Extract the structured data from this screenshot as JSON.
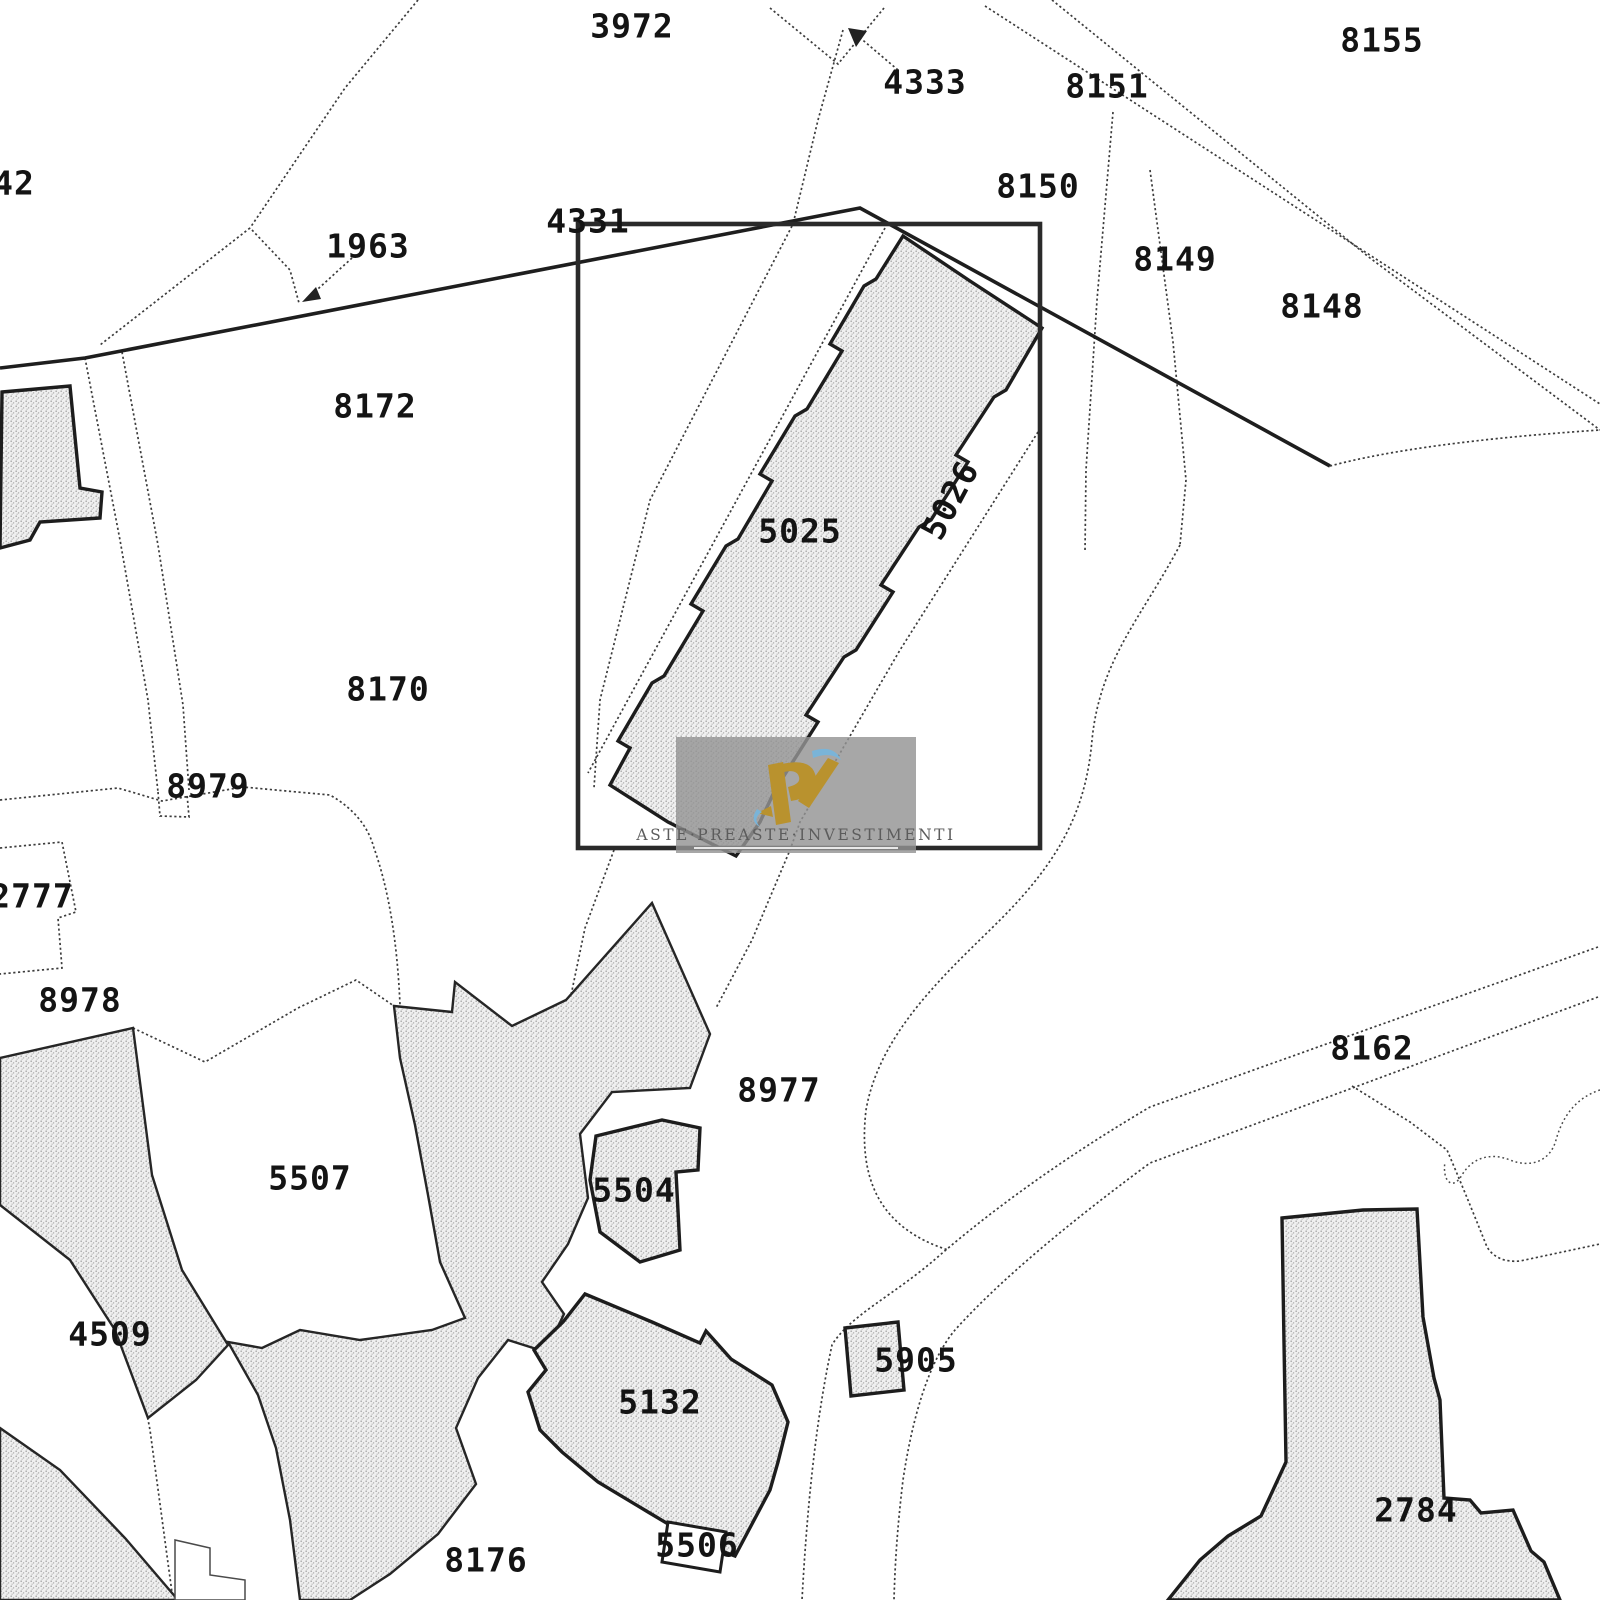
{
  "map": {
    "type": "cadastral-extract",
    "background_color": "#ffffff",
    "line_color": "#3c3c3c",
    "bold_line_color": "#1e1e1e",
    "stipple_dot_color": "#a8a8a8",
    "stipple_bg_color": "#f0f0f0",
    "label_color": "#141414",
    "highlight_box": {
      "x": 578,
      "y": 224,
      "width": 462,
      "height": 624
    },
    "labels": [
      {
        "text": "3972",
        "x": 632,
        "y": 26,
        "rotation": 0
      },
      {
        "text": "4333",
        "x": 925,
        "y": 82,
        "rotation": 0
      },
      {
        "text": "8155",
        "x": 1382,
        "y": 40,
        "rotation": 0
      },
      {
        "text": "8151",
        "x": 1107,
        "y": 86,
        "rotation": 0
      },
      {
        "text": "8150",
        "x": 1038,
        "y": 186,
        "rotation": 0
      },
      {
        "text": "8149",
        "x": 1175,
        "y": 259,
        "rotation": 0
      },
      {
        "text": "8148",
        "x": 1322,
        "y": 306,
        "rotation": 0
      },
      {
        "text": "42",
        "x": 14,
        "y": 183,
        "rotation": 0
      },
      {
        "text": "1963",
        "x": 368,
        "y": 246,
        "rotation": 0
      },
      {
        "text": "4331",
        "x": 588,
        "y": 221,
        "rotation": 0
      },
      {
        "text": "8172",
        "x": 375,
        "y": 406,
        "rotation": 0
      },
      {
        "text": "5025",
        "x": 800,
        "y": 531,
        "rotation": 0
      },
      {
        "text": "5026",
        "x": 950,
        "y": 500,
        "rotation": -62
      },
      {
        "text": "8170",
        "x": 388,
        "y": 689,
        "rotation": 0
      },
      {
        "text": "8979",
        "x": 208,
        "y": 786,
        "rotation": 0
      },
      {
        "text": "2777",
        "x": 32,
        "y": 896,
        "rotation": 0
      },
      {
        "text": "8978",
        "x": 80,
        "y": 1000,
        "rotation": 0
      },
      {
        "text": "8977",
        "x": 779,
        "y": 1090,
        "rotation": 0
      },
      {
        "text": "8162",
        "x": 1372,
        "y": 1048,
        "rotation": 0
      },
      {
        "text": "5507",
        "x": 310,
        "y": 1178,
        "rotation": 0
      },
      {
        "text": "5504",
        "x": 634,
        "y": 1190,
        "rotation": 0
      },
      {
        "text": "4509",
        "x": 110,
        "y": 1334,
        "rotation": 0
      },
      {
        "text": "5905",
        "x": 916,
        "y": 1360,
        "rotation": 0
      },
      {
        "text": "5132",
        "x": 660,
        "y": 1402,
        "rotation": 0
      },
      {
        "text": "5506",
        "x": 697,
        "y": 1545,
        "rotation": 0
      },
      {
        "text": "8176",
        "x": 486,
        "y": 1560,
        "rotation": 0
      },
      {
        "text": "2784",
        "x": 1416,
        "y": 1510,
        "rotation": 0
      }
    ],
    "watermark": {
      "text": "ASTE·PREASTE·INVESTIMENTI",
      "panel_color": "rgba(148,148,148,0.82)",
      "text_color": "#5c5c5c",
      "underline_color": "#e8e8e8",
      "logo_gold": "#b9922e",
      "logo_blue": "#7ab4d8"
    }
  }
}
